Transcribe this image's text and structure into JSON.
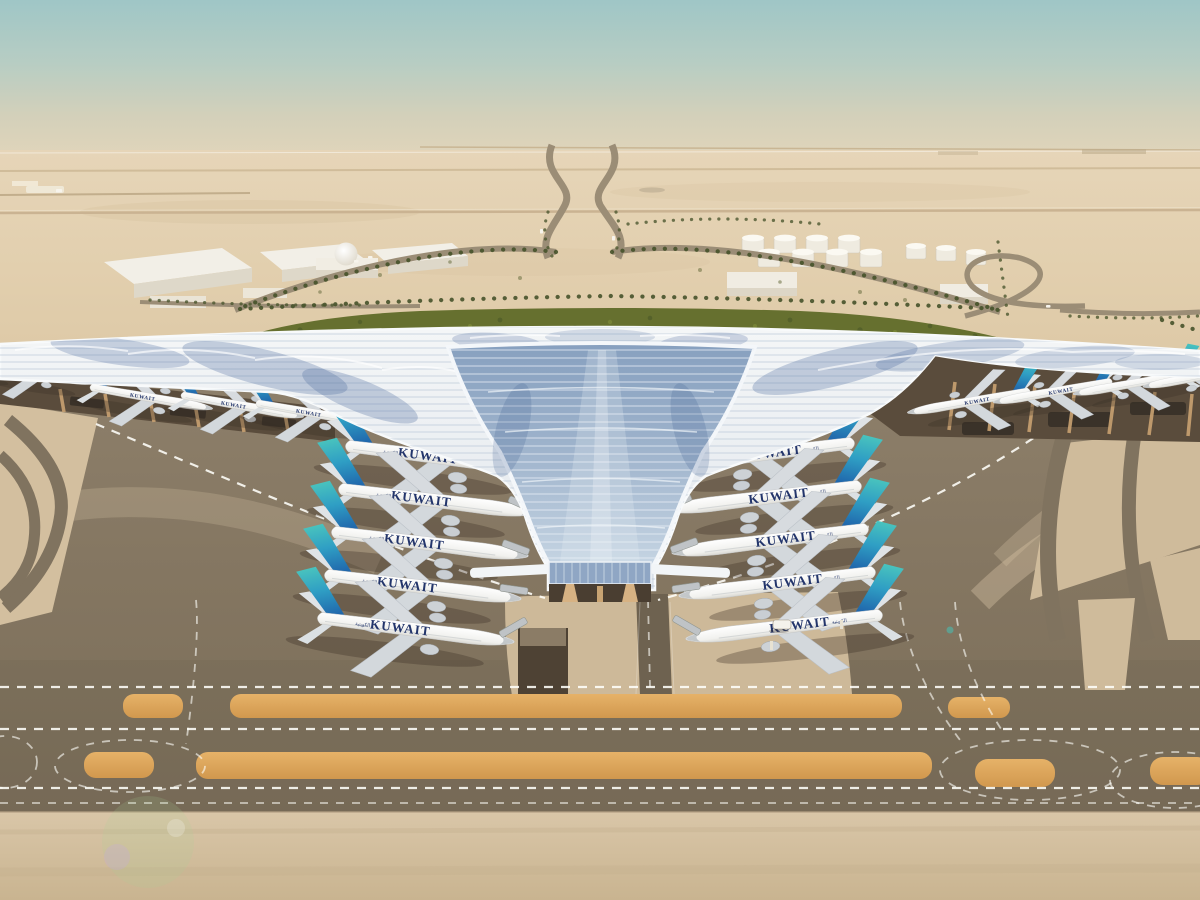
{
  "scene": {
    "type": "aerial architectural rendering",
    "subject": "Kuwait airport terminal with trefoil roof",
    "setting": "desert airfield with parked airliners, taxiways, palm-lined approach roads and fuel tanks"
  },
  "livery": {
    "airline": "KUWAIT",
    "arabic": "الكويتية"
  },
  "aircraft": {
    "left_concourse": 5,
    "right_concourse": 5,
    "left_pier": 5,
    "right_pier": 4,
    "total_visible": 19
  },
  "palette": {
    "sky_teal": "#9fc6c6",
    "desert_sand": "#e2cfae",
    "apron_grey": "#847661",
    "orange_strip": "#dda55f",
    "roof_white": "#f4f6f7",
    "glass_blue": "#87a0bf",
    "tail_teal": "#4cc8bd",
    "tail_blue": "#1c57a5",
    "livery_navy": "#23356b",
    "greenery": "#66702f"
  }
}
